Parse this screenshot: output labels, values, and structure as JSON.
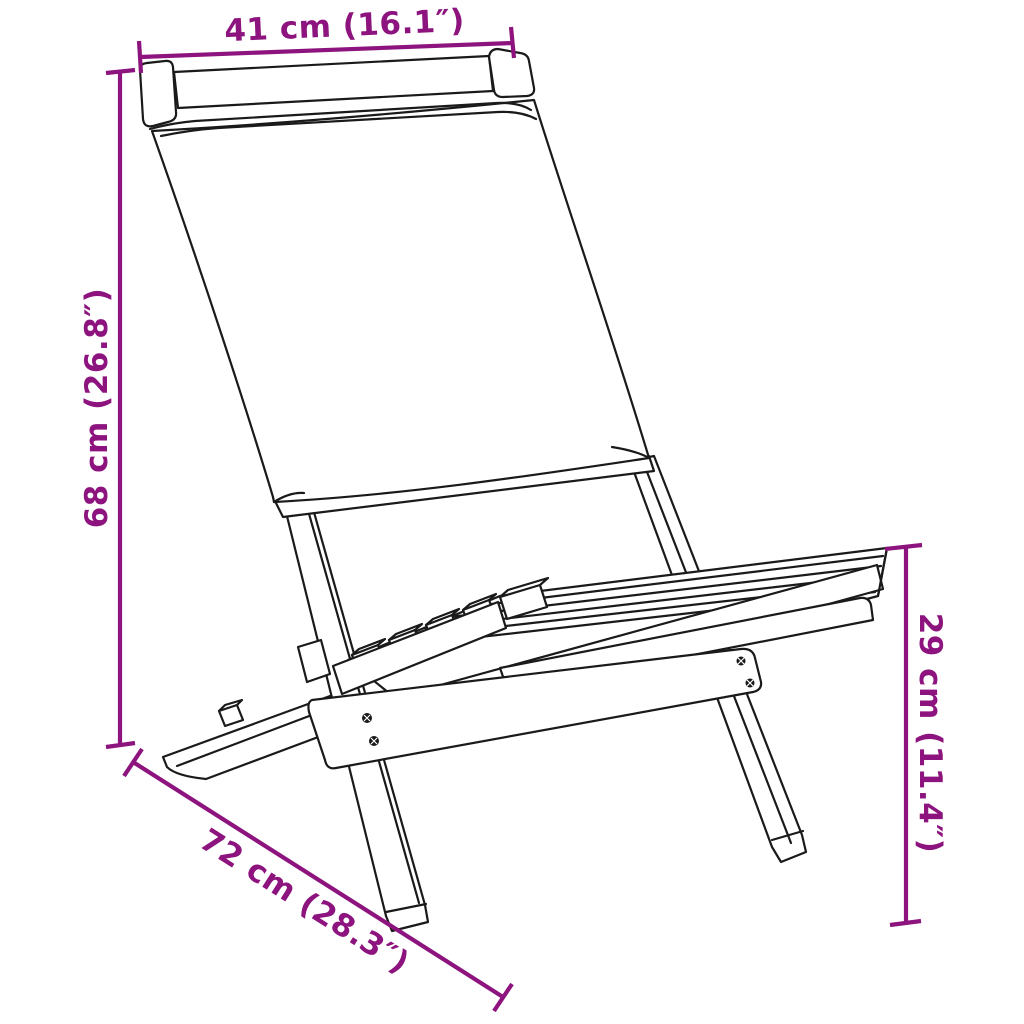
{
  "diagram": {
    "kind": "product-dimension-line-drawing",
    "subject": "folding fabric chair with wooden frame",
    "colors": {
      "dimension": "#8D147E",
      "outline": "#1a1a1a",
      "background": "#ffffff"
    },
    "dimensions": {
      "width": {
        "label": "41 cm (16.1″)",
        "placement": "top"
      },
      "height": {
        "label": "68 cm (26.8″)",
        "placement": "left"
      },
      "seat_height": {
        "label": "29 cm (11.4″)",
        "placement": "right"
      },
      "depth": {
        "label": "72 cm (28.3″)",
        "placement": "bottom-left-diagonal"
      }
    }
  }
}
